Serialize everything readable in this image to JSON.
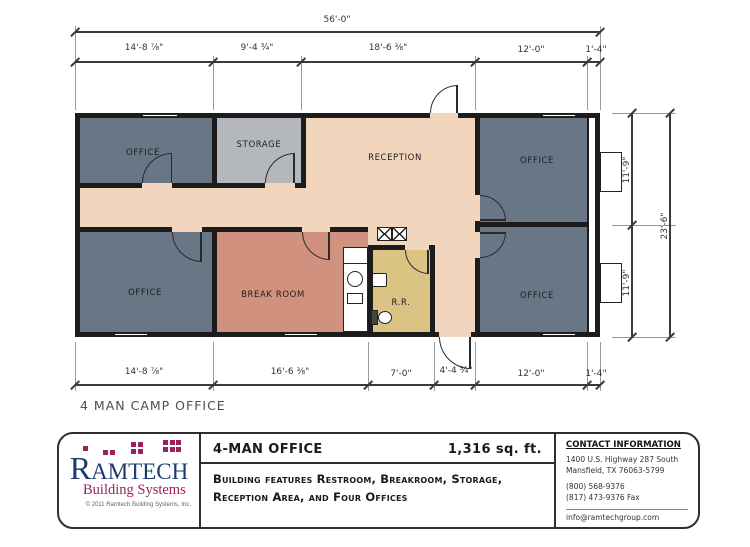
{
  "plan": {
    "title": "4 MAN CAMP OFFICE",
    "rooms": {
      "office": "OFFICE",
      "storage": "STORAGE",
      "reception": "RECEPTION",
      "break_room": "BREAK ROOM",
      "restroom": "R.R."
    },
    "dims": {
      "overall_width": "56'-0\"",
      "top": [
        "14'-8 ⅞\"",
        "9'-4 ¾\"",
        "18'-6 ⅜\"",
        "12'-0\"",
        "1'-4\""
      ],
      "bottom": [
        "14'-8 ⅞\"",
        "16'-6 ⅜\"",
        "7'-0\"",
        "4'-4 ¾\"",
        "12'-0\"",
        "1'-4\""
      ],
      "right_upper": "11'-9\"",
      "right_lower": "11'-9\"",
      "right_overall": "23'-6\""
    }
  },
  "footer": {
    "logo": {
      "name": "RAMTECH",
      "tagline": "Building Systems",
      "copyright": "© 2011 Ramtech Building Systems, Inc."
    },
    "model_title": "4-MAN OFFICE",
    "area": "1,316 sq. ft.",
    "description": "Building features Restroom, Breakroom, Storage, Reception Area, and Four Offices",
    "contact": {
      "heading": "CONTACT INFORMATION",
      "address_line1": "1400 U.S. Highway 287 South",
      "address_line2": "Mansfield, TX 76063-5799",
      "phone": "(800) 568-9376",
      "fax": "(817) 473-9376 Fax",
      "email": "info@ramtechgroup.com"
    }
  },
  "colors": {
    "wall": "#1c1c1c",
    "office_fill": "#697685",
    "storage_fill": "#b4b8bd",
    "reception_fill": "#f2d5bd",
    "break_room_fill": "#d0927f",
    "restroom_fill": "#dbc383",
    "logo_blue": "#1e3a6d",
    "logo_magenta": "#9e1f5f"
  }
}
